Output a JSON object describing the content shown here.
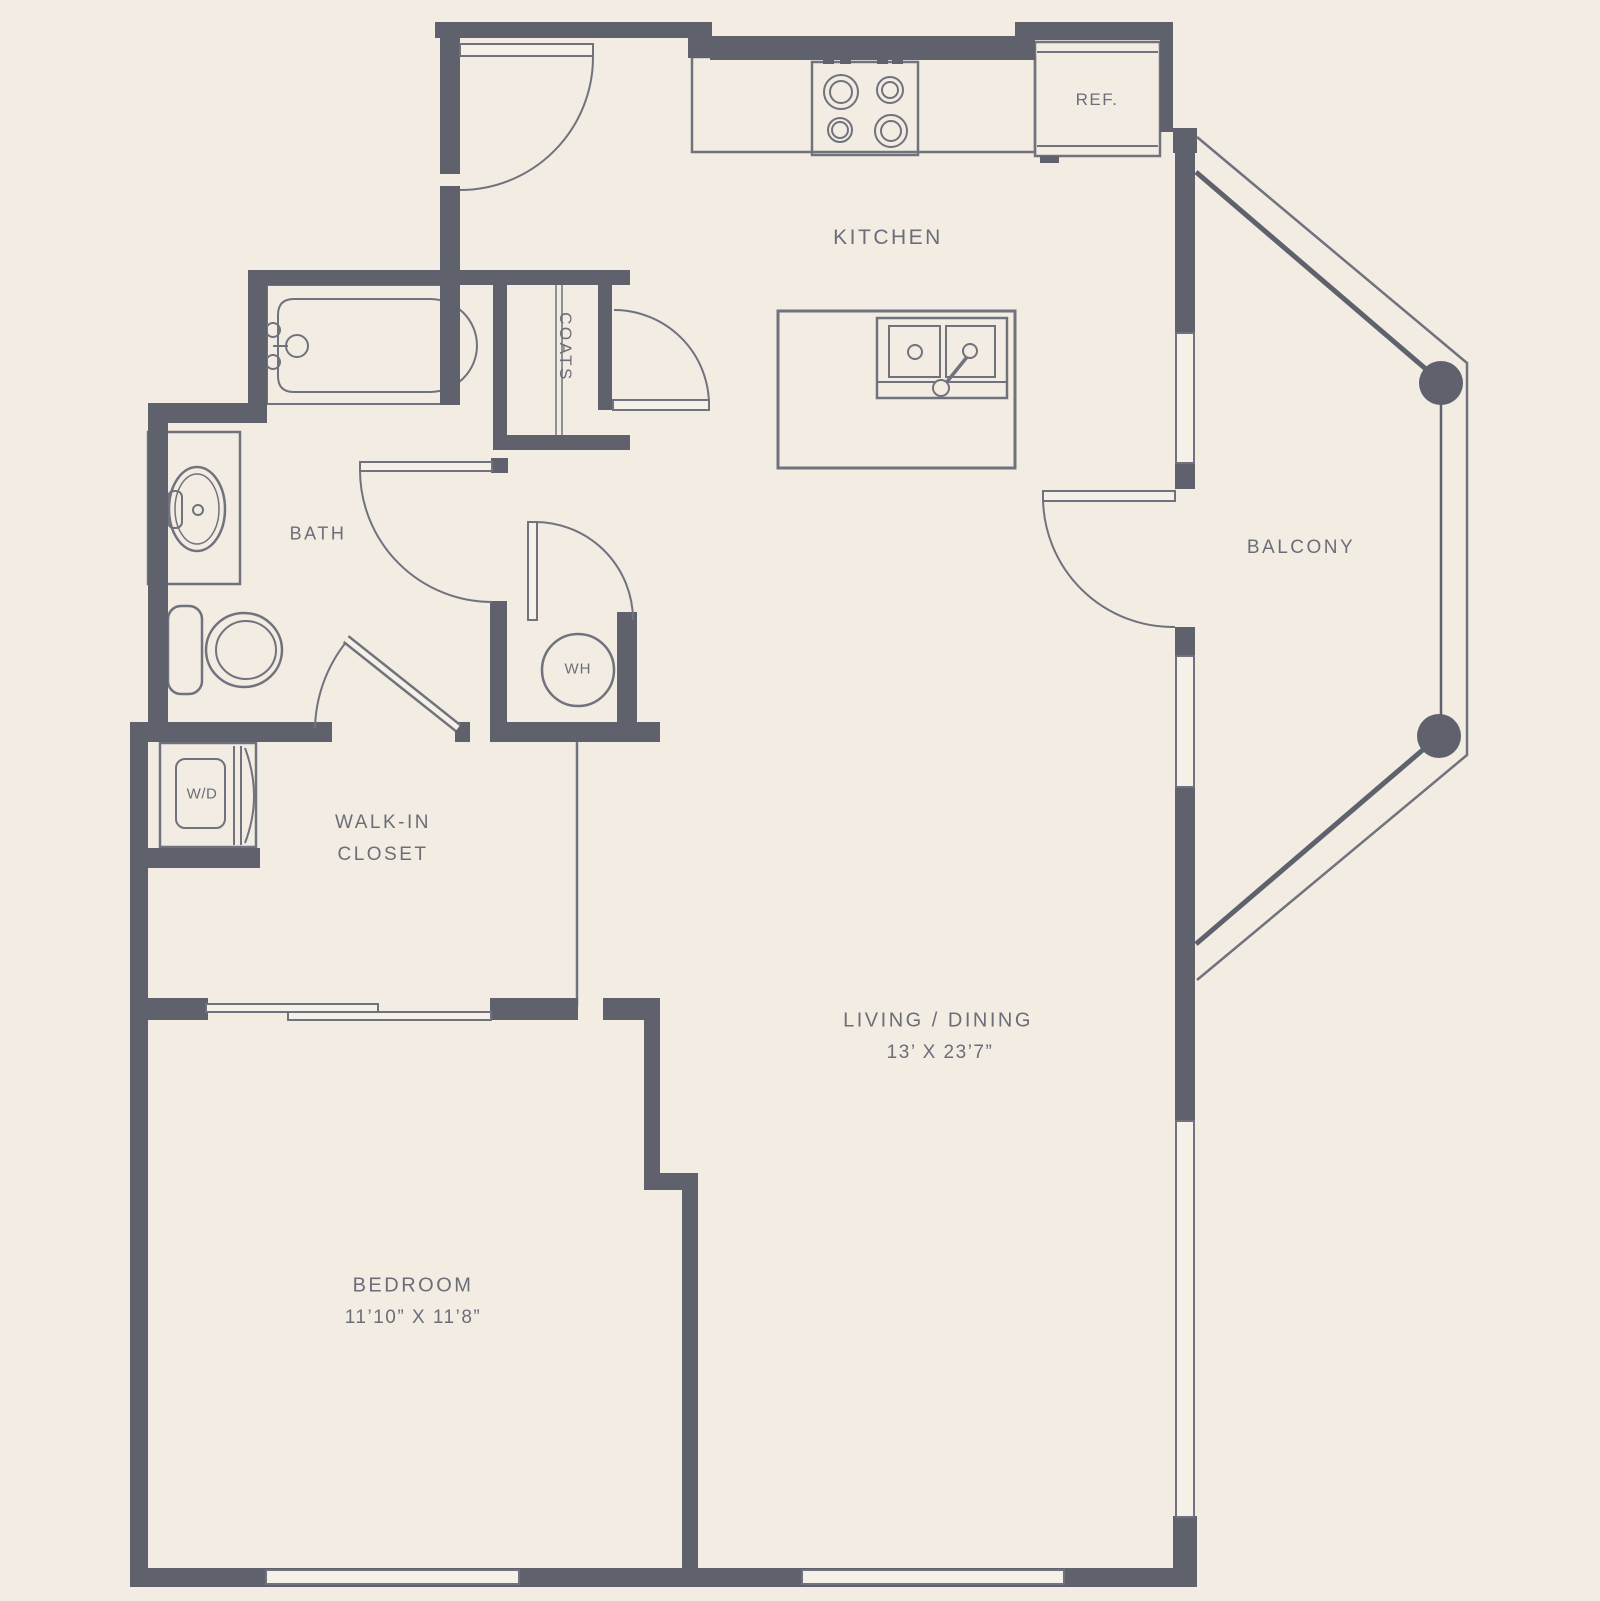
{
  "title": "One-bedroom apartment floor plan",
  "colors": {
    "floor": "#f2ece2",
    "wall": "#5f626c",
    "fixture_line": "#70737d",
    "window_fill": "#f6f1e8",
    "text": "#6b6e79"
  },
  "rooms": {
    "kitchen": {
      "label": "KITCHEN"
    },
    "bath": {
      "label": "BATH"
    },
    "coats_closet": {
      "label": "COATS"
    },
    "walk_in_closet": {
      "label_line1": "WALK-IN",
      "label_line2": "CLOSET"
    },
    "living_dining": {
      "label": "LIVING / DINING",
      "dimensions": "13’ X 23’7”"
    },
    "bedroom": {
      "label": "BEDROOM",
      "dimensions": "11’10” X 11’8”"
    },
    "balcony": {
      "label": "BALCONY"
    }
  },
  "fixtures": {
    "refrigerator": {
      "label": "REF."
    },
    "water_heater": {
      "label": "WH"
    },
    "washer_dryer": {
      "label": "W/D"
    }
  }
}
